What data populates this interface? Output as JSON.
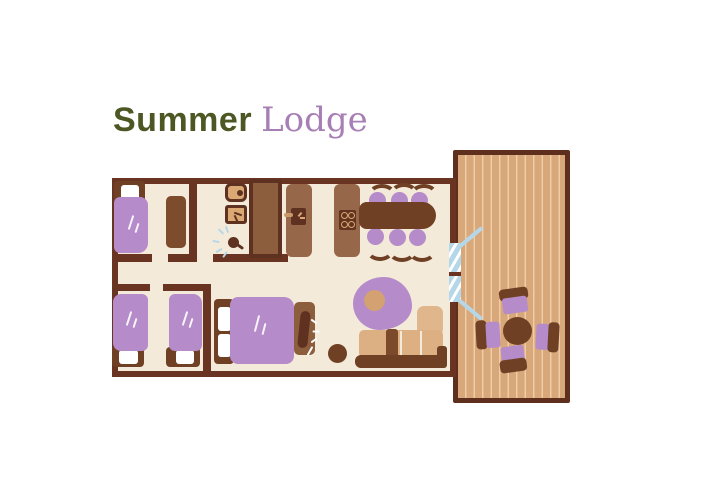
{
  "title": {
    "word1": "Summer",
    "word2": "Lodge"
  },
  "palette": {
    "title_green": "#4d5724",
    "title_purple": "#a87fb5",
    "wall_brown": "#6a3422",
    "floor_cream": "#f3ead9",
    "furniture_dark_brown": "#6f4024",
    "furniture_mid_brown": "#97674a",
    "wardrobe_brown": "#7d4c2c",
    "fitting_tan": "#d9a873",
    "deck_wood": "#d8a77a",
    "deck_plank_line": "#eecda7",
    "sofa_tan": "#ddb083",
    "textile_purple": "#b58bc9",
    "glass_blue": "#b5d7ea"
  },
  "plan": {
    "rooms": [
      "single-bedroom",
      "bathroom",
      "kitchen-dining",
      "twin-bedroom",
      "double-bedroom",
      "living-area",
      "decking"
    ],
    "furniture_counts": {
      "single_beds": 3,
      "double_beds": 1,
      "dining_chairs": 6,
      "deck_chairs": 4,
      "wardrobes": 1,
      "sofas": 1
    }
  }
}
